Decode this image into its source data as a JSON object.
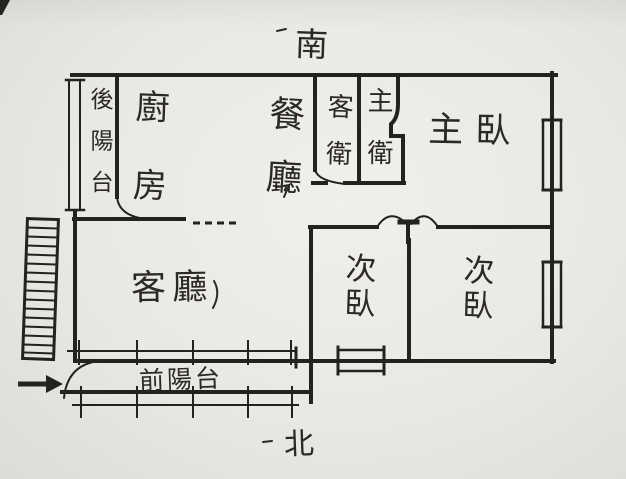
{
  "compass": {
    "south": "南",
    "north": "北"
  },
  "rooms": {
    "back_balcony": {
      "label": "後陽台"
    },
    "kitchen": {
      "label": "廚房"
    },
    "dining": {
      "label": "餐廳"
    },
    "guest_bath": {
      "label": "客衛"
    },
    "master_bath": {
      "label": "主衛"
    },
    "master_bedroom": {
      "label": "主臥"
    },
    "living": {
      "label": "客廳"
    },
    "bedroom2_left": {
      "label": "次臥"
    },
    "bedroom2_right": {
      "label": "次臥"
    },
    "front_balcony": {
      "label": "前陽台"
    }
  },
  "colors": {
    "paper": "#eae8e3",
    "ink": "#232220"
  },
  "icons": {
    "stairs": "stairs-icon",
    "entrance_arrow": "entrance-arrow-icon",
    "door_swing": "door-arc-icon",
    "window": "window-icon"
  }
}
